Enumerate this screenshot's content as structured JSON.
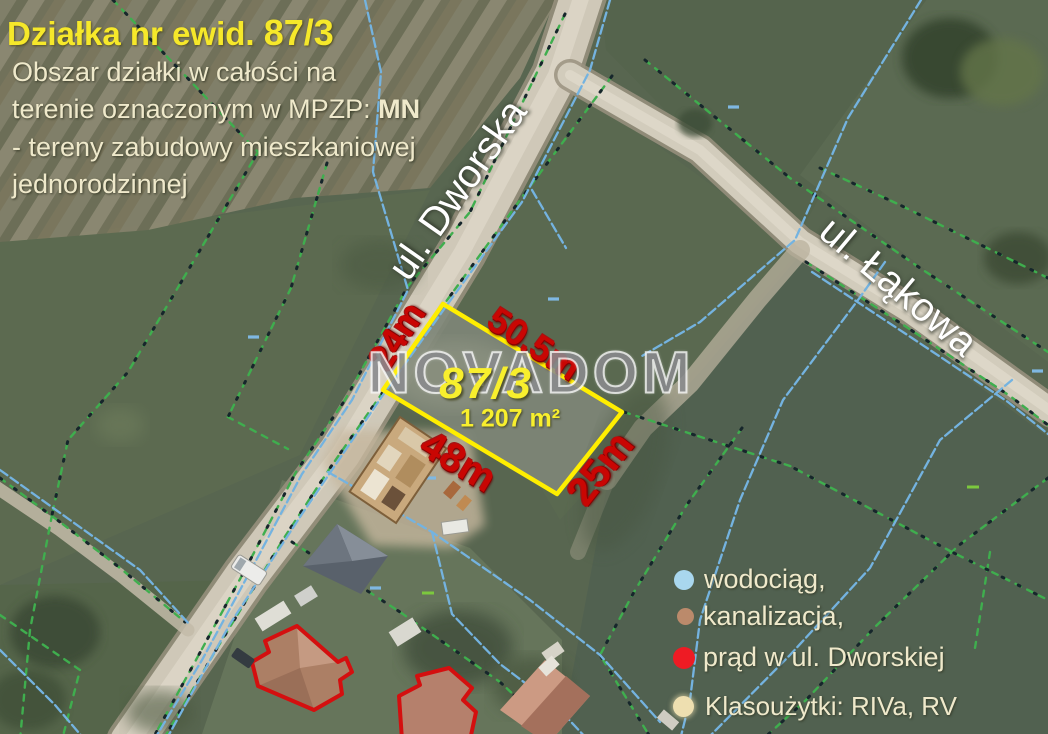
{
  "header": {
    "title": "Działka nr ewid. ",
    "title_number": "87/3",
    "line1": "Obszar działki  w całości na",
    "line2": "terenie oznaczonym w MPZP: ",
    "line2_bold": "MN",
    "line3": "- tereny zabudowy mieszkaniowej",
    "line4": "jednorodzinnej"
  },
  "streets": {
    "dworska": "ul. Dworska",
    "lakowa": "ul. Łąkowa"
  },
  "parcel": {
    "number": "87/3",
    "area": "1 207 m²",
    "dim_left": "24m",
    "dim_top": "50.5m",
    "dim_bottom": "48m",
    "dim_right": "25m"
  },
  "watermark": "NOVADOM",
  "legend": {
    "items": [
      {
        "label": "wodociąg,",
        "color": "#a9d7ee"
      },
      {
        "label": "kanalizacja,",
        "color": "#bb8a6b"
      },
      {
        "label": "prąd w ul. Dworskiej",
        "color": "#ee1b24"
      },
      {
        "label": "Klasoużytki: RIVa, RV",
        "color": "#eedfb0"
      }
    ]
  },
  "colors": {
    "title_yellow": "#f6e82a",
    "text_cream": "#efe9cb",
    "dimension_red": "#c90603",
    "plot_outline_yellow": "#ffee00",
    "street_white": "#ffffff",
    "watermark_gray": "#8a8b8e",
    "parcel_label_yellow": "#f8ef2d"
  }
}
